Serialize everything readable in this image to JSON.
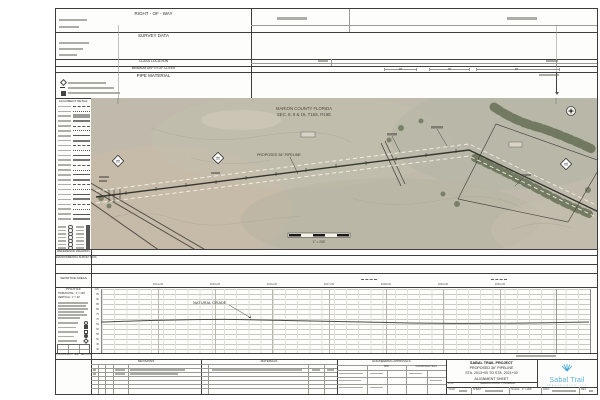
{
  "header": {
    "right_of_way": "RIGHT - OF - WAY",
    "survey_data": "SURVEY DATA",
    "class_location": "CLASS LOCATION",
    "min_depth_of_cover": "MINIMUM DEPTH OF COVER",
    "pipe_material": "PIPE MATERIAL"
  },
  "legend": {
    "alignment_detail": "ALIGNMENT DETAIL:",
    "alignment_row_count": 24,
    "mini_row_count": 7,
    "reference_drawing": "REFERENCE DRAWING",
    "environmental_survey": "ENVIRONMENTAL SURVEY DATA",
    "sensitive_areas": "SENSITIVE AREAS",
    "hydrostatic": "HYDROSTATIC TEST SECTION"
  },
  "map": {
    "county_line1": "MARION COUNTY FLORIDA",
    "county_line2": "SEC. 8, 9 & 16, T16S, R19E",
    "pipeline_label": "PROPOSED 36\" PIPELINE",
    "scale_label": "1\" = 200'",
    "tree_color": "#5e6a4e",
    "photo_tones": [
      "#bfbaab",
      "#c8baa7",
      "#b6b6a6"
    ]
  },
  "profile": {
    "title": "PROFILE",
    "horizontal_scale": "HORIZONTAL: 1\" = 200'",
    "vertical_scale": "VERTICAL: 1\" = 20'",
    "natural_grade_label": "NATURAL GRADE",
    "station_ticks": [
      "2014+00",
      "2015+00",
      "2016+00",
      "2017+00",
      "2018+00",
      "2019+00",
      "2020+00"
    ],
    "elevation_ticks": [
      "100",
      "95",
      "90",
      "85",
      "80",
      "75",
      "70",
      "65",
      "60",
      "55",
      "50",
      "45",
      "40"
    ]
  },
  "chart_data": {
    "type": "line",
    "title": "PROFILE — NATURAL GRADE",
    "xlabel": "STATION",
    "ylabel": "ELEVATION (FT)",
    "x": [
      "2013+00",
      "2014+00",
      "2015+00",
      "2016+00",
      "2017+00",
      "2018+00",
      "2019+00",
      "2020+00",
      "2021+00"
    ],
    "series": [
      {
        "name": "NATURAL GRADE",
        "values": [
          71,
          72,
          73,
          72.5,
          71.5,
          71,
          70.5,
          70.5,
          71
        ]
      }
    ],
    "ylim": [
      40,
      100
    ],
    "grid": true,
    "legend_position": "none"
  },
  "tables": {
    "revisions_title": "REVISIONS",
    "materials_title": "MATERIALS",
    "approvals_title": "ENGINEERING APPROVALS",
    "approvals_bid": "BID",
    "approvals_construction": "CONSTRUCTION"
  },
  "title_block": {
    "line1": "SABAL TRAIL PROJECT",
    "line2": "PROPOSED 36\" PIPELINE",
    "line3": "STA. 2013+00 TO STA. 2021+00",
    "line4": "ALIGNMENT SHEET",
    "loc_label": "LOC:",
    "loc_value": "MARION COUNTY, FLORIDA",
    "year_label": "YEAR:",
    "sheet_label": "SHEET:",
    "scale_label": "SCALE:",
    "scale_value": "1\" = 200'",
    "dwg_label": "DWG:",
    "rev_label": "REV:"
  },
  "logo": {
    "name": "Sabal Trail",
    "subtitle": "TRANSMISSION, LLC",
    "color": "#5fb0d8"
  }
}
